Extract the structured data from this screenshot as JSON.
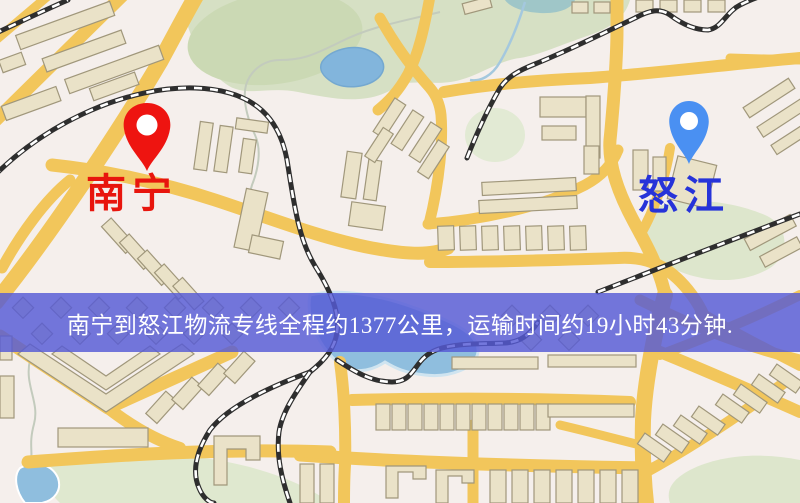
{
  "map": {
    "origin_marker": {
      "label": "南宁",
      "pin_color": "#ee1410",
      "pin_inner_color": "#ffffff",
      "label_color": "#e8150d"
    },
    "destination_marker": {
      "label": "怒江",
      "pin_color": "#4a90f2",
      "pin_inner_color": "#ffffff",
      "label_color": "#2633d9"
    },
    "banner": {
      "text": "南宁到怒江物流专线全程约1377公里，运输时间约19小时43分钟.",
      "background_color": "#575bd4",
      "text_color": "#ffffff",
      "distance_text": "约1377公里",
      "duration_text": "约19小时43分钟"
    }
  }
}
